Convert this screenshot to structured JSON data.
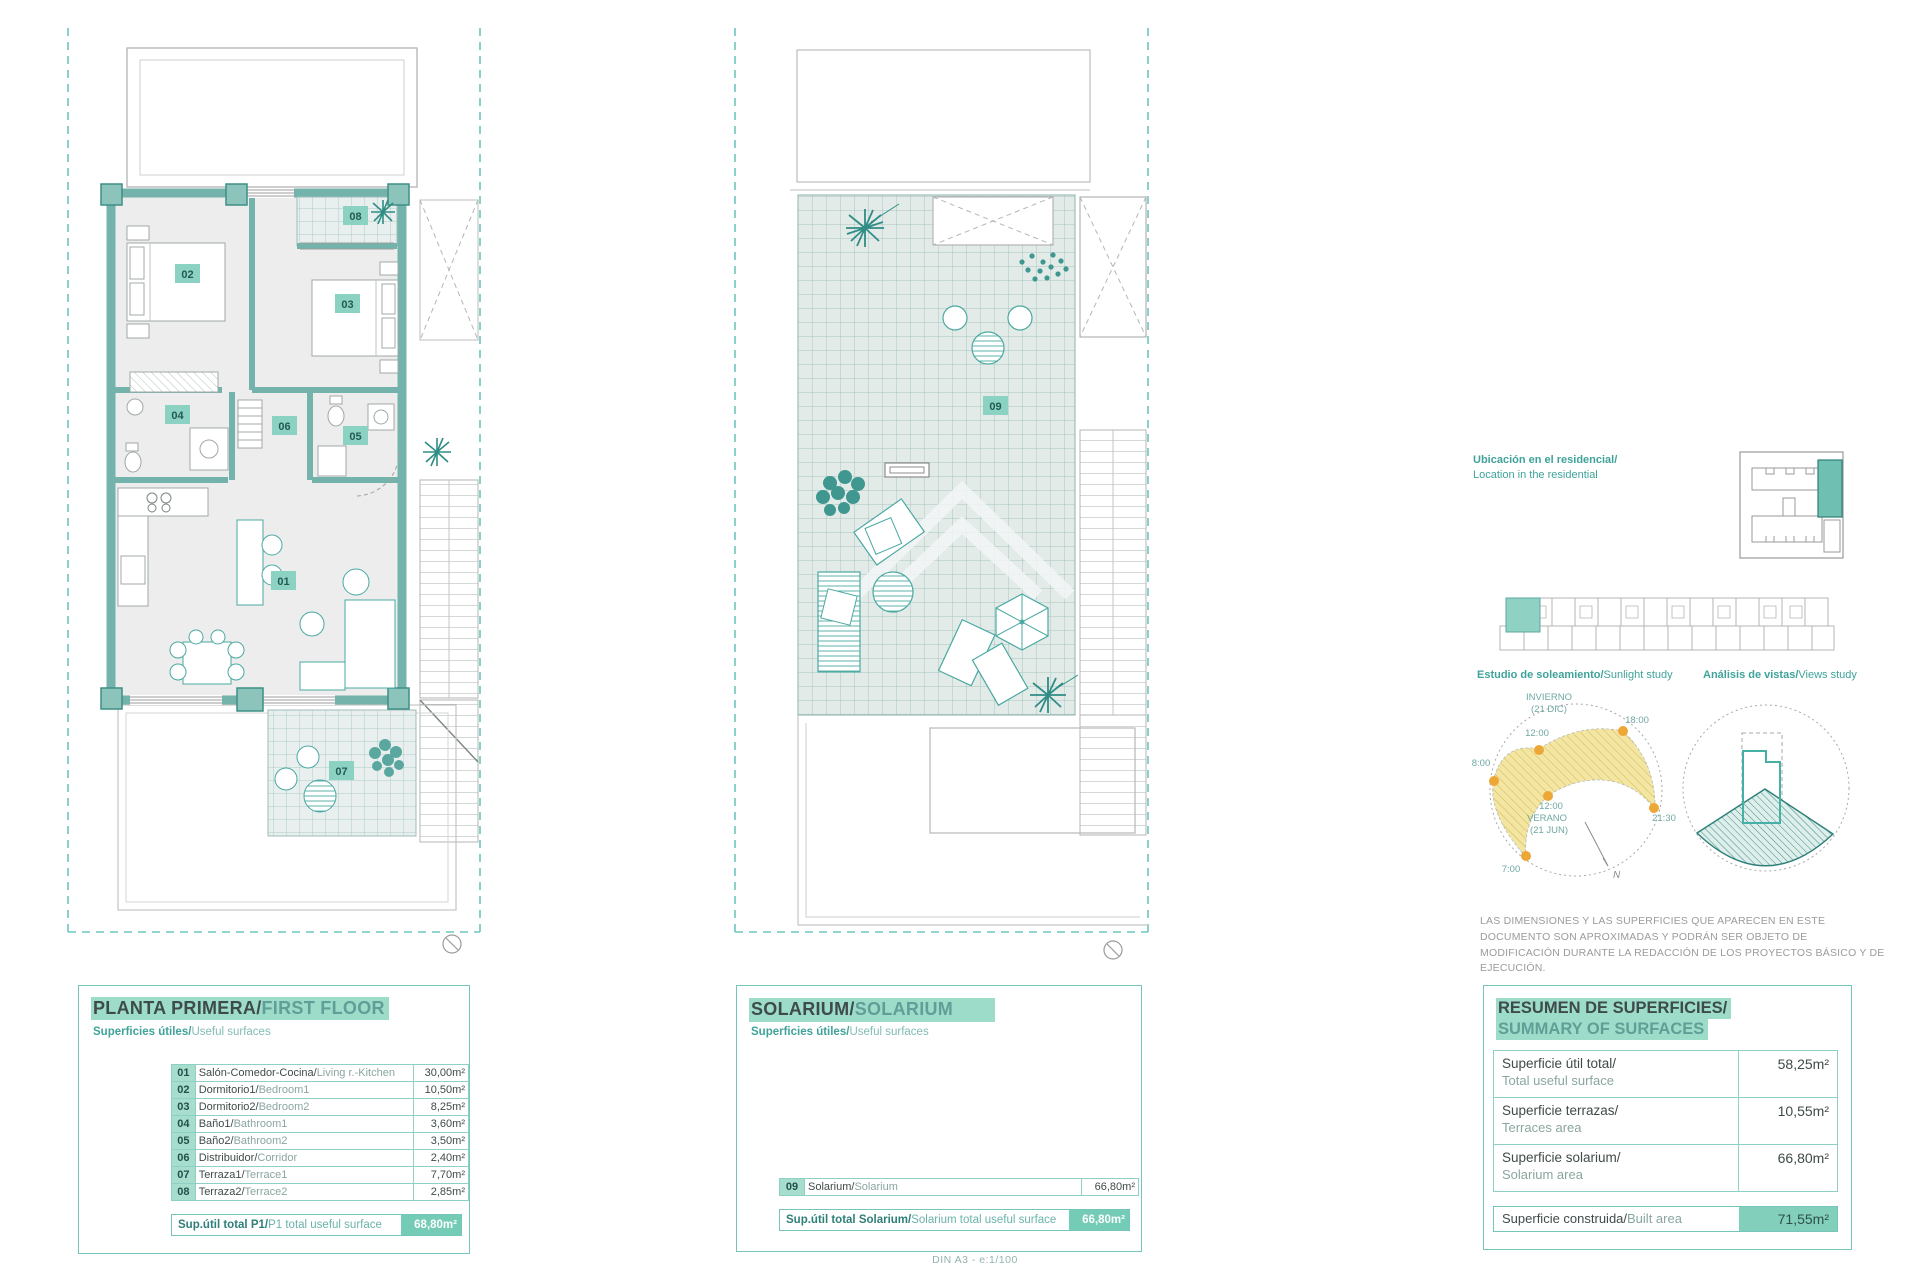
{
  "page": {
    "footer": "DIN A3 - e:1/100"
  },
  "floor_panel": {
    "title_es": "PLANTA PRIMERA/",
    "title_en": "FIRST FLOOR",
    "subtitle_es": "Superficies útiles/",
    "subtitle_en": "Useful surfaces",
    "rooms": [
      {
        "num": "01",
        "name_es": "Salón-Comedor-Cocina/",
        "name_en": "Living r.-Kitchen",
        "area": "30,00m²"
      },
      {
        "num": "02",
        "name_es": "Dormitorio1/",
        "name_en": "Bedroom1",
        "area": "10,50m²"
      },
      {
        "num": "03",
        "name_es": "Dormitorio2/",
        "name_en": "Bedroom2",
        "area": "8,25m²"
      },
      {
        "num": "04",
        "name_es": "Baño1/",
        "name_en": "Bathroom1",
        "area": "3,60m²"
      },
      {
        "num": "05",
        "name_es": "Baño2/",
        "name_en": "Bathroom2",
        "area": "3,50m²"
      },
      {
        "num": "06",
        "name_es": "Distribuidor/",
        "name_en": "Corridor",
        "area": "2,40m²"
      },
      {
        "num": "07",
        "name_es": "Terraza1/",
        "name_en": "Terrace1",
        "area": "7,70m²"
      },
      {
        "num": "08",
        "name_es": "Terraza2/",
        "name_en": "Terrace2",
        "area": "2,85m²"
      }
    ],
    "total_label_es": "Sup.útil total P1/",
    "total_label_en": "P1 total useful surface",
    "total_value": "68,80m²"
  },
  "solarium_panel": {
    "title_es": "SOLARIUM/",
    "title_en": "SOLARIUM",
    "subtitle_es": "Superficies útiles/",
    "subtitle_en": "Useful surfaces",
    "rooms": [
      {
        "num": "09",
        "name_es": "Solarium/",
        "name_en": "Solarium",
        "area": "66,80m²"
      }
    ],
    "total_label_es": "Sup.útil total Solarium/",
    "total_label_en": "Solarium total useful surface",
    "total_value": "66,80m²"
  },
  "summary_panel": {
    "title_es": "RESUMEN DE SUPERFICIES/",
    "title_en": "SUMMARY OF SURFACES",
    "rows": [
      {
        "label_es": "Superficie útil total/",
        "label_en": "Total useful surface",
        "value": "58,25m²"
      },
      {
        "label_es": "Superficie terrazas/",
        "label_en": "Terraces area",
        "value": "10,55m²"
      },
      {
        "label_es": "Superficie solarium/",
        "label_en": "Solarium area",
        "value": "66,80m²"
      }
    ],
    "built_label_es": "Superficie construida/",
    "built_label_en": "Built area",
    "built_value": "71,55m²"
  },
  "location": {
    "label_es": "Ubicación en el residencial/",
    "label_en": "Location in the residential"
  },
  "sunlight": {
    "label_es": "Estudio de soleamiento/",
    "label_en": "Sunlight study",
    "winter_1": "INVIERNO",
    "winter_2": "(21 DIC)",
    "summer_1": "12:00",
    "summer_2": "VERANO",
    "summer_3": "(21 JUN)",
    "t_1200": "12:00",
    "t_1800": "18:00",
    "t_0800": "8:00",
    "t_2130": "21:30",
    "t_0700": "7:00",
    "north": "N"
  },
  "views": {
    "label_es": "Análisis de vistas/",
    "label_en": "Views study"
  },
  "disclaimer": "LAS DIMENSIONES Y LAS SUPERFICIES QUE APARECEN EN ESTE DOCUMENTO SON APROXIMADAS Y PODRÁN SER OBJETO DE MODIFICACIÓN DURANTE LA REDACCIÓN DE LOS PROYECTOS BÁSICO Y DE EJECUCIÓN.",
  "colors": {
    "accent_teal": "#4aa9a1",
    "wall_teal": "#74b3ab",
    "highlight": "#9edcca",
    "sun_yellow": "#f3e6a2",
    "sun_dot_orange": "#eda737"
  }
}
